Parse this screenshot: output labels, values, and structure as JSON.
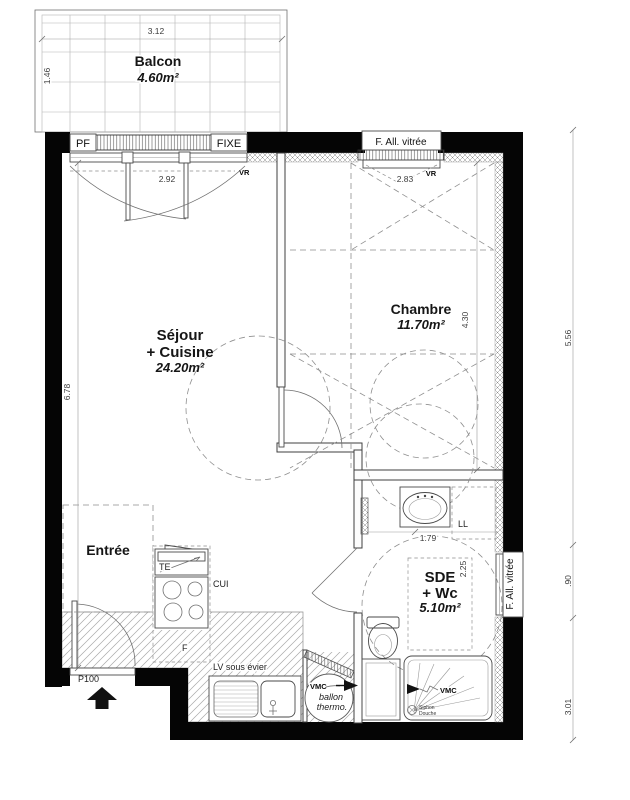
{
  "rooms": {
    "balcon": {
      "name": "Balcon",
      "area": "4.60m²"
    },
    "sejour": {
      "line1": "Séjour",
      "line2": "+ Cuisine",
      "area": "24.20m²"
    },
    "chambre": {
      "name": "Chambre",
      "area": "11.70m²"
    },
    "entree": {
      "name": "Entrée"
    },
    "sde": {
      "line1": "SDE",
      "line2": "+ Wc",
      "area": "5.10m²"
    }
  },
  "dimensions": {
    "balcon_width": "3.12",
    "balcon_depth": "1.46",
    "sejour_window": "2.92",
    "chambre_window": "2.83",
    "sejour_height": "6.78",
    "chambre_height": "4.30",
    "sde_width": "1.79",
    "sde_depth": "2.25",
    "right_top": "5.56",
    "right_mid": ".90",
    "right_bottom": "3.01"
  },
  "openings": {
    "pf": "PF",
    "fixe": "FIXE",
    "f_all_top": "F. All. vitrée",
    "f_all_right": "F. All. vitrée",
    "vr_sejour": "VR",
    "vr_chambre": "VR",
    "entry_door": "P100"
  },
  "equipment": {
    "te": "TE",
    "cui": "CUI",
    "fridge": "F",
    "lv": "LV sous évier",
    "ll": "LL",
    "vmc_ballon": "VMC",
    "vmc_shower": "VMC",
    "ballon_line1": "ballon",
    "ballon_line2": "thermo.",
    "siphon_line1": "Siphon",
    "siphon_line2": "Douche"
  }
}
